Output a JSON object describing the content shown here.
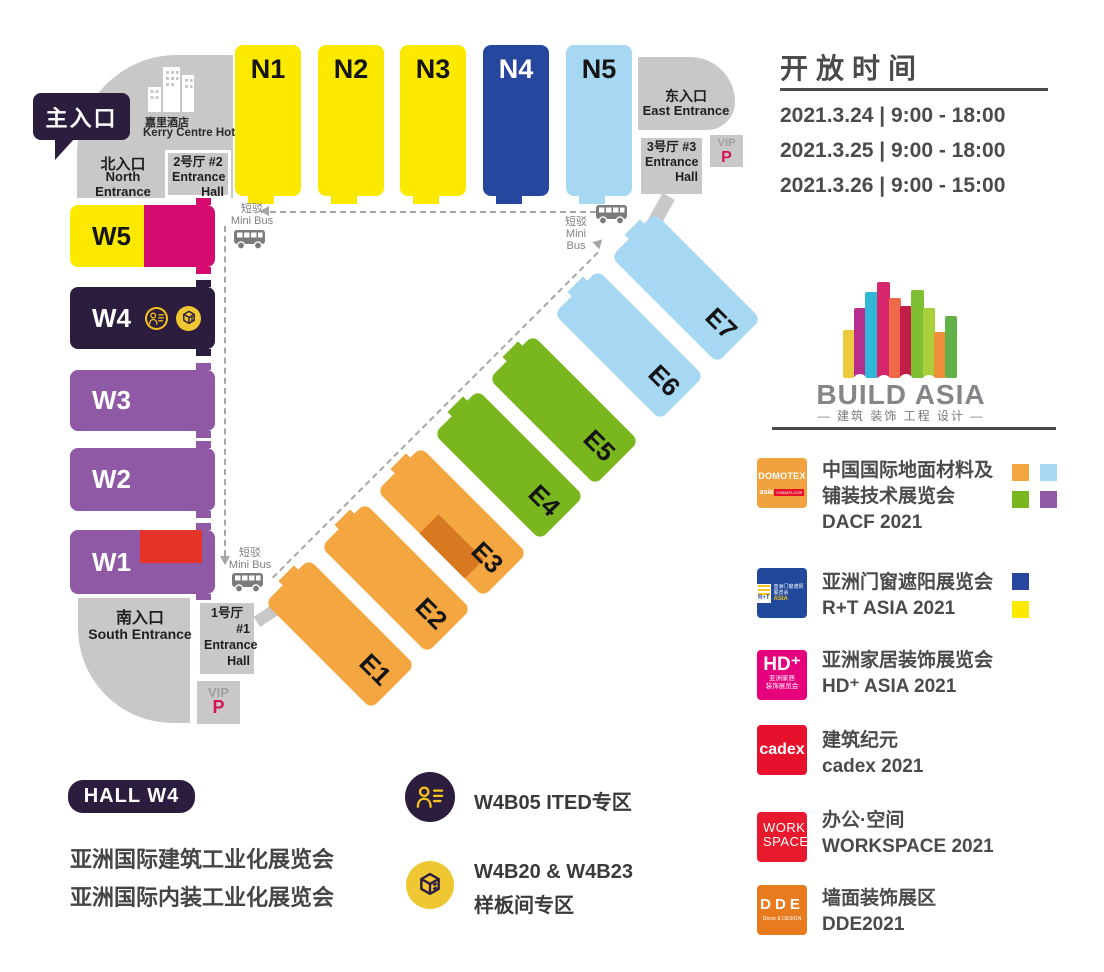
{
  "colors": {
    "yellow": "#fbe900",
    "magenta": "#d40a6e",
    "dark_purple": "#2c1d3f",
    "purple": "#9059a5",
    "red": "#e6332a",
    "orange": "#f4a640",
    "dark_orange": "#d87820",
    "green": "#7ab61e",
    "light_blue": "#a6d7f3",
    "dark_blue": "#27479e",
    "entrance_gray": "#c9c7c7",
    "text_dark": "#4b4b4d",
    "vip_p": "#d4145a",
    "icon_yellow": "#f5c518"
  },
  "open_hours": {
    "title": "开放时间",
    "rows": [
      "2021.3.24 | 9:00 - 18:00",
      "2021.3.25 | 9:00 - 18:00",
      "2021.3.26 | 9:00 - 15:00"
    ]
  },
  "map": {
    "main_entrance_badge": "主入口",
    "hotel": {
      "cn": "嘉里酒店",
      "en": "Kerry Centre Hotel"
    },
    "north_entrance": {
      "cn": "北入口",
      "en": "North Entrance"
    },
    "east_entrance": {
      "cn": "东入口",
      "en": "East Entrance"
    },
    "south_entrance": {
      "cn": "南入口",
      "en": "South Entrance"
    },
    "entrance_hall_1": {
      "line1": "1号厅",
      "line2": "#1",
      "line3": "Entrance",
      "line4": "Hall"
    },
    "entrance_hall_2": {
      "line1": "2号厅  #2",
      "line2": "Entrance",
      "line3": "Hall"
    },
    "entrance_hall_3": {
      "line1": "3号厅  #3",
      "line2": "Entrance",
      "line3": "Hall"
    },
    "vip": "VIP",
    "parking": "P",
    "mini_bus": {
      "cn": "短驳",
      "en": "Mini Bus"
    },
    "n_halls": [
      {
        "label": "N1",
        "color": "#fbe900",
        "text_color": "#141414"
      },
      {
        "label": "N2",
        "color": "#fbe900",
        "text_color": "#141414"
      },
      {
        "label": "N3",
        "color": "#fbe900",
        "text_color": "#141414"
      },
      {
        "label": "N4",
        "color": "#27479e",
        "text_color": "#ffffff"
      },
      {
        "label": "N5",
        "color": "#a6d7f3",
        "text_color": "#141414"
      }
    ],
    "w_halls": {
      "w5": {
        "label": "W5",
        "left_color": "#fbe900",
        "right_color": "#d40a6e",
        "text_color": "#141414"
      },
      "w4": {
        "label": "W4",
        "color": "#2c1d3f",
        "text_color": "#ffffff"
      },
      "w3": {
        "label": "W3",
        "color": "#9059a5",
        "text_color": "#ffffff"
      },
      "w2": {
        "label": "W2",
        "color": "#9059a5",
        "text_color": "#ffffff"
      },
      "w1": {
        "label": "W1",
        "color": "#9059a5",
        "accent_color": "#e6332a",
        "text_color": "#ffffff"
      }
    },
    "e_halls": [
      {
        "label": "E1",
        "color": "#f4a640"
      },
      {
        "label": "E2",
        "color": "#f4a640"
      },
      {
        "label": "E3",
        "color": "#f4a640",
        "sub_color": "#d87820"
      },
      {
        "label": "E4",
        "color": "#7ab61e"
      },
      {
        "label": "E5",
        "color": "#7ab61e"
      },
      {
        "label": "E6",
        "color": "#a6d7f3"
      },
      {
        "label": "E7",
        "color": "#a6d7f3"
      }
    ]
  },
  "logo": {
    "name": "BUILD ASIA",
    "tagline": "— 建筑 装饰 工程 设计 —",
    "palette": [
      "#ecc93d",
      "#b82e8d",
      "#31b8d9",
      "#d6276d",
      "#f0684a",
      "#c01e46",
      "#7fbf33",
      "#a9cf3a",
      "#ef8f3a",
      "#62b24a"
    ]
  },
  "legend": {
    "items": [
      {
        "logo_line1": "DOMOTEX",
        "logo_line2": "asia",
        "logo_line3": "CHINAFLOOR",
        "logo_bg": "#f0a23e",
        "lines": [
          "中国国际地面材料及",
          "铺装技术展览会",
          "DACF 2021"
        ],
        "swatches": [
          "#f4a640",
          "#a6d7f3",
          "#7ab61e",
          "#9059a5"
        ]
      },
      {
        "logo_line1": "R+T",
        "logo_line2": "亚洲门窗遮阳展览会",
        "logo_line3": "ASIA",
        "logo_bg": "#20489b",
        "lines": [
          "亚洲门窗遮阳展览会",
          "R+T ASIA 2021"
        ],
        "swatches": [
          "#27479e",
          "#fbe900"
        ]
      },
      {
        "logo_line1": "HD⁺",
        "logo_line2": "亚洲家居",
        "logo_line3": "装饰展览会",
        "logo_bg": "#e6007e",
        "lines": [
          "亚洲家居装饰展览会",
          "HD⁺ ASIA 2021"
        ],
        "swatches": []
      },
      {
        "logo_line1": "cadex",
        "logo_bg": "#e8112d",
        "lines": [
          "建筑纪元",
          "cadex 2021"
        ],
        "swatches": []
      },
      {
        "logo_line1": "WORK",
        "logo_line2": "SPACE",
        "logo_bg": "#e8192c",
        "lines": [
          "办公·空间",
          "WORKSPACE 2021"
        ],
        "swatches": []
      },
      {
        "logo_line1": "DDE",
        "logo_line2": "Décor & DESIGN",
        "logo_bg": "#e87b1e",
        "lines": [
          "墙面装饰展区",
          "DDE2021"
        ],
        "swatches": []
      }
    ]
  },
  "hall_w4_info": {
    "badge": "HALL W4",
    "lines": [
      "亚洲国际建筑工业化展览会",
      "亚洲国际内装工业化展览会"
    ],
    "features": [
      {
        "text": "W4B05 ITED专区"
      },
      {
        "text": "W4B20 & W4B23",
        "text2": "样板间专区"
      }
    ]
  }
}
